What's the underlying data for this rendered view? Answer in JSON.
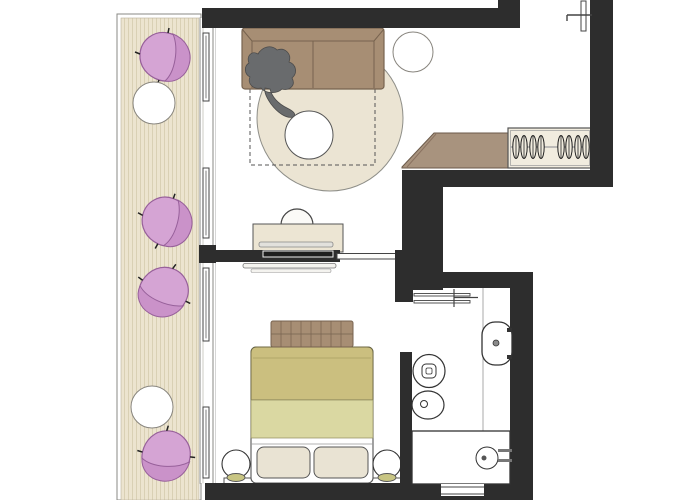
{
  "document": {
    "kind": "floor-plan",
    "visible_text": []
  },
  "colors": {
    "paper": "#ffffff",
    "wall": "#2d2d2d",
    "deck": "#ece4cf",
    "deck-stripe": "#d9d0b4",
    "frame-line": "#8a8a84",
    "sofa": "#a78e74",
    "sofa-line": "#77634f",
    "counter": "#a8937e",
    "counter-line": "#6b5a4a",
    "rug": "#ebe4d3",
    "plant": "#d5a4d4",
    "plant-dark": "#ca92c9",
    "plant-line": "#97609a",
    "bed-olive": "#cbbf7f",
    "bed-olive-light": "#dad8a2",
    "bed-fold": "#b2a76a",
    "pillow": "#e9e3d3",
    "lamp-base": "#c8c583",
    "closet": "#f1ecdf",
    "figure": "#696b6d",
    "figure-line": "#4b4b4b",
    "fixture": "#333333",
    "light-line": "#aaaaaa"
  },
  "inventory": {
    "balcony": {
      "wood_deck": 1,
      "plants": 4,
      "round_tables": 2,
      "sliding_window_panels": 4
    },
    "living_room": {
      "sofa": 1,
      "person_figure": 1,
      "round_rug": 1,
      "coffee_table": 1,
      "side_stool": 1,
      "desk": 1,
      "desk_chair": 1,
      "ceiling_projection_dashed": 1
    },
    "entry": {
      "wardrobe": 1,
      "hangers": 8,
      "bench_counter": 1,
      "entry_door_leaf": 1
    },
    "bedroom": {
      "double_bed": 1,
      "quilted_throw": 1,
      "pillows": 2,
      "bedside_lamps": 2,
      "headboard_shelf": 1,
      "tv": 1,
      "media_console": 1,
      "sliding_door_leaf": 1
    },
    "bathroom": {
      "sliding_door": 1,
      "vanity_counter": 1,
      "washbasin": 1,
      "toilet": 1,
      "bidet": 1,
      "bathtub": 1,
      "window_notch": 1
    }
  }
}
